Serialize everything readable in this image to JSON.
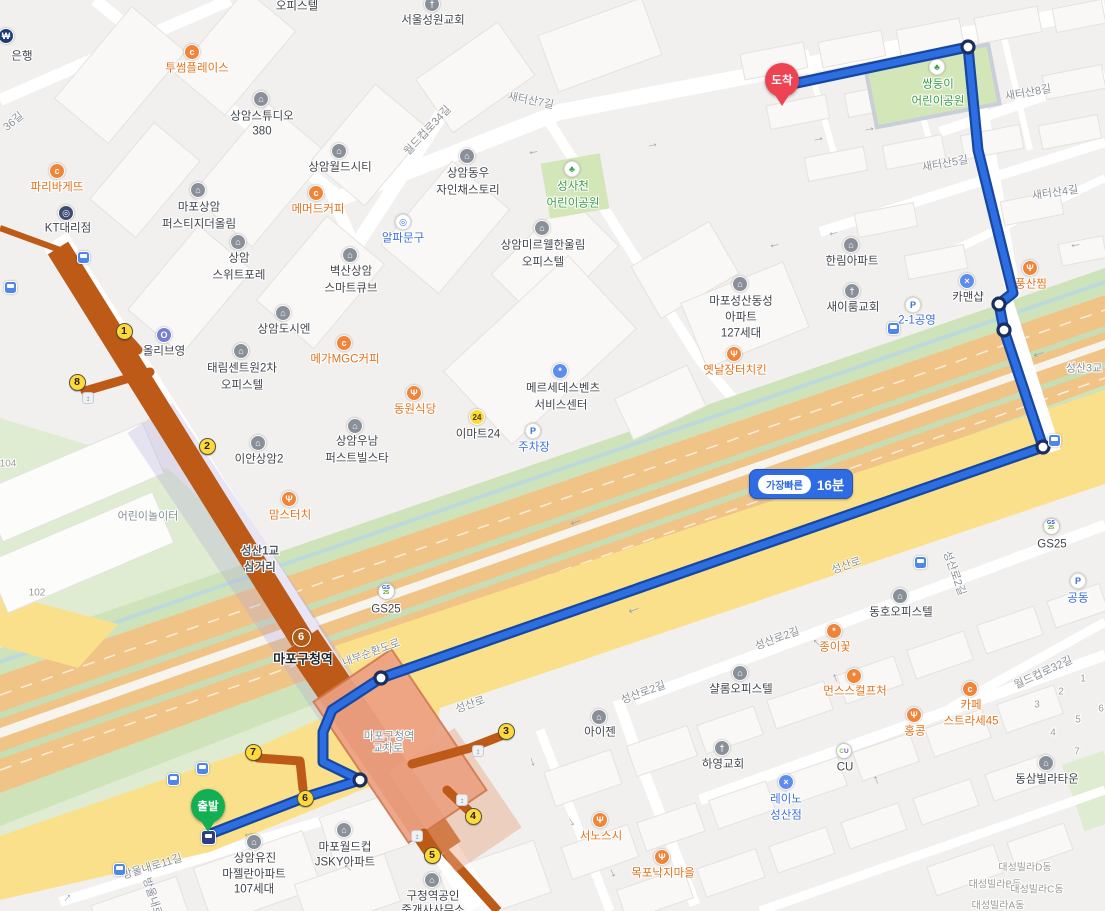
{
  "route_badge": {
    "label": "가장빠른",
    "time": "16분"
  },
  "markers": {
    "start": "출발",
    "end": "도착"
  },
  "station": {
    "line_number": "6",
    "name": "마포구청역"
  },
  "exits": {
    "e1": "1",
    "e2": "2",
    "e3": "3",
    "e4": "4",
    "e5": "5",
    "e6": "6",
    "e7": "7",
    "e8": "8"
  },
  "store_badges": {
    "gs_top": "GS",
    "gs_bottom": "25",
    "cu_c": "C",
    "cu_u": "U",
    "emart": "24"
  },
  "icons": {
    "building": "⌂",
    "church": "†",
    "restaurant": "Ψ",
    "cafe": "c",
    "tree": "♣",
    "wrench": "×",
    "parking": "P",
    "shop": "*",
    "target": "◎",
    "bank": "₩",
    "kt": "◎",
    "beauty": "O",
    "benz": "*",
    "arrow_left": "←",
    "arrow_right": "→",
    "arrow_up": "↑",
    "arrow_down": "↓",
    "transfer": "↕"
  },
  "pois": [
    {
      "lines": [
        "은행"
      ]
    },
    {
      "lines": [
        "투썸플레이스"
      ]
    },
    {
      "lines": [
        "오피스텔"
      ]
    },
    {
      "lines": [
        "서울성원교회"
      ]
    },
    {
      "lines": [
        "상암스튜디오",
        "380"
      ]
    },
    {
      "lines": [
        "상암월드시티"
      ]
    },
    {
      "lines": [
        "파리바게뜨"
      ]
    },
    {
      "lines": [
        "KT대리점"
      ]
    },
    {
      "lines": [
        "마포상암",
        "퍼스티지더올림"
      ]
    },
    {
      "lines": [
        "메머드커피"
      ]
    },
    {
      "lines": [
        "상암",
        "스위트포레"
      ]
    },
    {
      "lines": [
        "벽산상암",
        "스마트큐브"
      ]
    },
    {
      "lines": [
        "알파문구"
      ]
    },
    {
      "lines": [
        "상암동우",
        "자인채스토리"
      ]
    },
    {
      "lines": [
        "성사천",
        "어린이공원"
      ]
    },
    {
      "lines": [
        "상암미르웰한울림",
        "오피스텔"
      ]
    },
    {
      "lines": [
        "쌍둥이",
        "어린이공원"
      ]
    },
    {
      "lines": [
        "한림아파트"
      ]
    },
    {
      "lines": [
        "새이룸교회"
      ]
    },
    {
      "lines": [
        "카맨샵"
      ]
    },
    {
      "lines": [
        "풍산찜"
      ]
    },
    {
      "lines": [
        "마포성산동성",
        "아파트",
        "127세대"
      ]
    },
    {
      "lines": [
        "옛날장터치킨"
      ]
    },
    {
      "lines": [
        "2-1공영"
      ]
    },
    {
      "lines": [
        "메르세데스벤츠",
        "서비스센터"
      ]
    },
    {
      "lines": [
        "동원식당"
      ]
    },
    {
      "lines": [
        "이마트24"
      ]
    },
    {
      "lines": [
        "주차장"
      ]
    },
    {
      "lines": [
        "올리브영"
      ]
    },
    {
      "lines": [
        "상암도시엔"
      ]
    },
    {
      "lines": [
        "태림센트원2차",
        "오피스텔"
      ]
    },
    {
      "lines": [
        "메가MGC커피"
      ]
    },
    {
      "lines": [
        "이안상암2"
      ]
    },
    {
      "lines": [
        "상암우남",
        "퍼스트빌스타"
      ]
    },
    {
      "lines": [
        "맘스터치"
      ]
    },
    {
      "lines": [
        "어린이놀이터"
      ]
    },
    {
      "lines": [
        "GS25"
      ]
    },
    {
      "lines": [
        "GS25"
      ]
    },
    {
      "lines": [
        "공동"
      ]
    },
    {
      "lines": [
        "아이젠"
      ]
    },
    {
      "lines": [
        "서노스시"
      ]
    },
    {
      "lines": [
        "목포낙지마을"
      ]
    },
    {
      "lines": [
        "하영교회"
      ]
    },
    {
      "lines": [
        "레이노",
        "성산점"
      ]
    },
    {
      "lines": [
        "CU"
      ]
    },
    {
      "lines": [
        "동삼빌라타운"
      ]
    },
    {
      "lines": [
        "동호오피스텔"
      ]
    },
    {
      "lines": [
        "종이꽃"
      ]
    },
    {
      "lines": [
        "먼스스컬프처"
      ]
    },
    {
      "lines": [
        "카페",
        "스트라세45"
      ]
    },
    {
      "lines": [
        "홍콩"
      ]
    },
    {
      "lines": [
        "샬롬오피스텔"
      ]
    },
    {
      "lines": [
        "마포월드컵",
        "JSKY아파트"
      ]
    },
    {
      "lines": [
        "상암유진",
        "마젤란아파트",
        "107세대"
      ]
    },
    {
      "lines": [
        "구청역공인",
        "중개사사무소"
      ]
    },
    {
      "lines": [
        "대성빌라D동"
      ]
    },
    {
      "lines": [
        "대성빌라B동"
      ]
    },
    {
      "lines": [
        "대성빌라C동"
      ]
    },
    {
      "lines": [
        "대성빌라A동"
      ]
    },
    {
      "lines": [
        "성산1교",
        "삼거리"
      ]
    },
    {
      "lines": [
        "마포구청역",
        "교차로"
      ]
    },
    {
      "lines": [
        "성산3교"
      ]
    }
  ],
  "roads": [
    "월드컵로34길",
    "새터산7길",
    "새터산8길",
    "새터산5길",
    "새터산4길",
    "36길",
    "내부순환도로",
    "성산로",
    "성산로",
    "성산로2길",
    "성산로2길",
    "성산로2길",
    "월드컵로32길",
    "방울내로11길",
    "방울내로"
  ],
  "addr": [
    "1",
    "2",
    "3",
    "4",
    "5",
    "6",
    "7",
    "104",
    "102"
  ]
}
